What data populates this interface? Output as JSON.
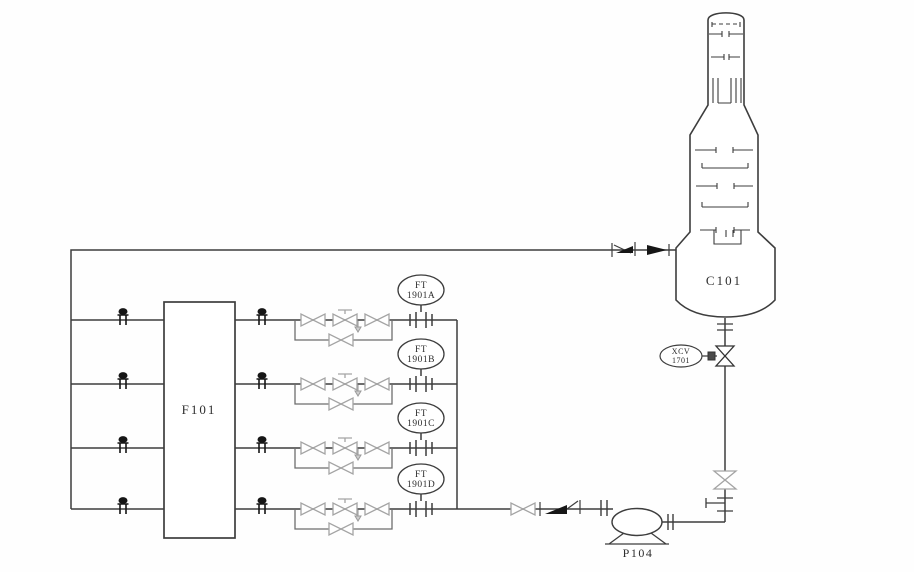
{
  "diagram": {
    "equipment": [
      {
        "id": "furnace",
        "label": "F101"
      },
      {
        "id": "column",
        "label": "C101"
      },
      {
        "id": "pump",
        "label": "P104"
      }
    ],
    "instruments": {
      "flow_transmitters": [
        {
          "line1": "FT",
          "line2": "1901A"
        },
        {
          "line1": "FT",
          "line2": "1901B"
        },
        {
          "line1": "FT",
          "line2": "1901C"
        },
        {
          "line1": "FT",
          "line2": "1901D"
        }
      ],
      "control_valve_tag": {
        "line1": "XCV",
        "line2": "1701"
      }
    },
    "colors": {
      "line": "#3d3d3d",
      "valve_gray": "#a4a4a4",
      "black": "#161616",
      "background": "#fefefe"
    }
  }
}
